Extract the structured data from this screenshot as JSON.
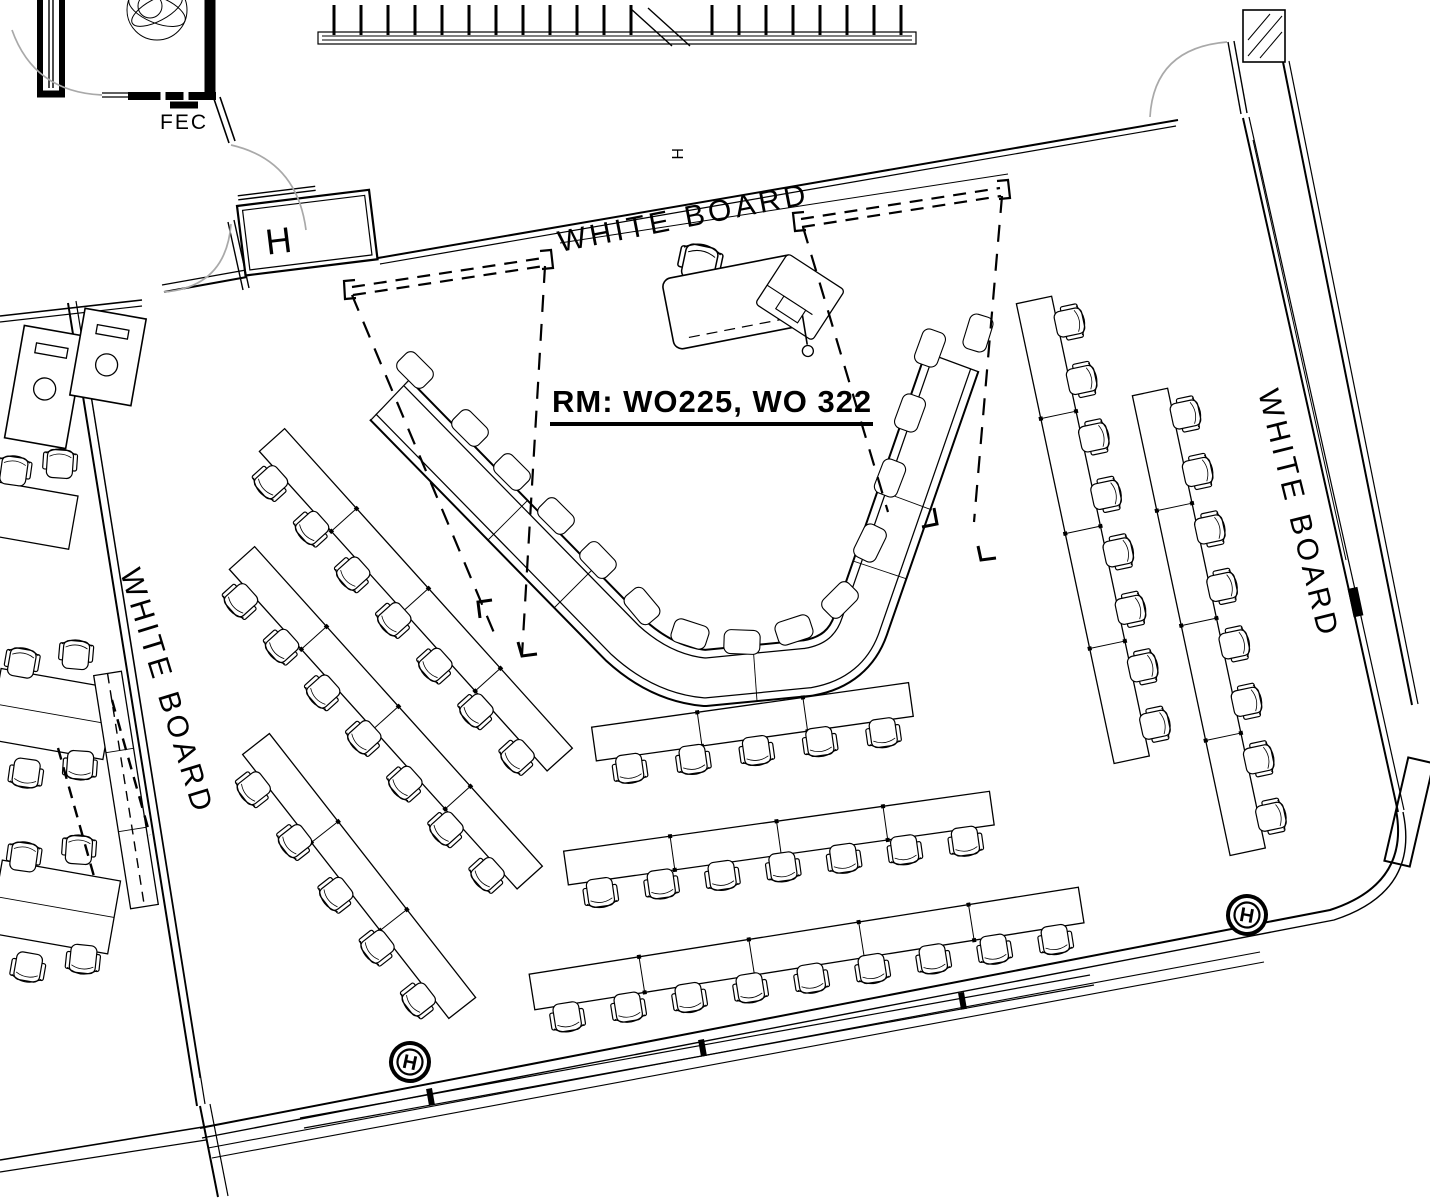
{
  "document": {
    "type": "architectural floor plan",
    "view": "classroom seating layout"
  },
  "labels": {
    "room_title": "RM: WO225, WO 322",
    "fec": "FEC",
    "whiteboard_top": "WHITE BOARD",
    "whiteboard_left": "WHITE BOARD",
    "whiteboard_right": "WHITE BOARD",
    "door_hold_symbol": "H"
  },
  "colors": {
    "line": "#000000",
    "door_arc": "#a9a9a9",
    "background": "#ffffff"
  },
  "symbols": {
    "floor_box_count": 2,
    "door_hold_count": 2,
    "whiteboard_count": 3
  },
  "furniture": {
    "banks": [
      {
        "id": "L1",
        "seats": 7
      },
      {
        "id": "L2",
        "seats": 7
      },
      {
        "id": "L3",
        "seats": 5
      },
      {
        "id": "R1",
        "seats": 8
      },
      {
        "id": "R2",
        "seats": 8
      },
      {
        "id": "B1",
        "seats": 5
      },
      {
        "id": "B2",
        "seats": 7
      },
      {
        "id": "B3",
        "seats": 9
      }
    ],
    "u_table_seats": 15,
    "left_room_seats": 10,
    "podium": {
      "station": "instructor podium with chair and AV cart"
    }
  }
}
